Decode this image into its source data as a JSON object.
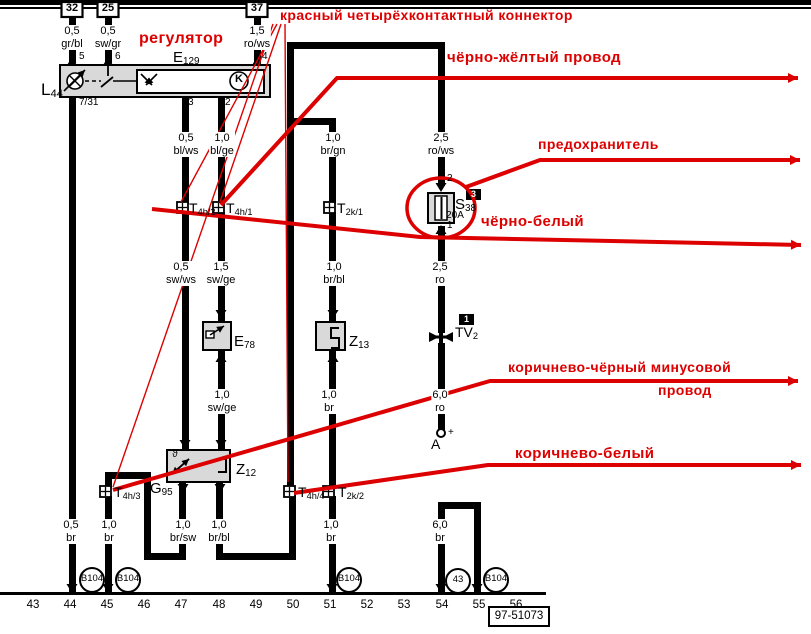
{
  "colors": {
    "wire": "#000000",
    "red": "#dd0000",
    "box_fill": "#d9d9d9"
  },
  "top_bus": {
    "bar": [
      0,
      0,
      811,
      5
    ],
    "line": [
      0,
      7,
      811,
      2
    ]
  },
  "ground_line": [
    0,
    592,
    546,
    3
  ],
  "terminals": [
    {
      "label": "32",
      "cx": 72
    },
    {
      "label": "25",
      "cx": 108
    },
    {
      "label": "37",
      "cx": 257
    }
  ],
  "segments": [
    [
      69,
      17,
      7,
      46
    ],
    [
      105,
      17,
      7,
      46
    ],
    [
      254,
      17,
      7,
      46
    ],
    [
      69,
      97,
      7,
      498
    ],
    [
      182,
      97,
      7,
      107
    ],
    [
      218,
      97,
      7,
      107
    ],
    [
      182,
      212,
      7,
      240
    ],
    [
      218,
      212,
      7,
      110
    ],
    [
      218,
      350,
      7,
      102
    ],
    [
      287,
      42,
      157,
      7
    ],
    [
      287,
      42,
      7,
      447
    ],
    [
      438,
      42,
      7,
      144
    ],
    [
      290,
      118,
      43,
      7
    ],
    [
      329,
      118,
      7,
      86
    ],
    [
      329,
      212,
      7,
      110
    ],
    [
      329,
      350,
      7,
      138
    ],
    [
      329,
      496,
      7,
      99
    ],
    [
      438,
      226,
      7,
      107
    ],
    [
      438,
      343,
      7,
      89
    ],
    [
      105,
      472,
      46,
      7
    ],
    [
      105,
      472,
      7,
      16
    ],
    [
      144,
      472,
      7,
      88
    ],
    [
      144,
      553,
      42,
      7
    ],
    [
      179,
      482,
      7,
      78
    ],
    [
      105,
      496,
      7,
      99
    ],
    [
      216,
      482,
      7,
      78
    ],
    [
      216,
      553,
      80,
      7
    ],
    [
      289,
      494,
      7,
      66
    ],
    [
      438,
      502,
      43,
      7
    ],
    [
      438,
      502,
      7,
      93
    ],
    [
      474,
      502,
      7,
      93
    ]
  ],
  "arrows": {
    "up": [
      [
        72,
        57
      ],
      [
        108,
        57
      ],
      [
        257,
        57
      ],
      [
        441,
        225
      ],
      [
        221,
        353
      ],
      [
        333,
        353
      ]
    ],
    "down": [
      [
        72,
        593
      ],
      [
        108,
        593
      ],
      [
        332,
        593
      ],
      [
        441,
        593
      ],
      [
        477,
        593
      ],
      [
        441,
        192
      ],
      [
        221,
        319
      ],
      [
        333,
        319
      ],
      [
        185,
        449
      ],
      [
        221,
        449
      ],
      [
        183,
        493
      ],
      [
        220,
        493
      ]
    ]
  },
  "boxes": [
    {
      "name": "e129-box",
      "r": [
        60,
        65,
        210,
        32
      ],
      "fill": "#d9d9d9"
    },
    {
      "name": "e129-inner-box",
      "r": [
        137,
        70,
        127,
        23
      ],
      "fill": "#ffffff"
    },
    {
      "name": "e78-box",
      "r": [
        203,
        322,
        28,
        28
      ],
      "fill": "#d9d9d9"
    },
    {
      "name": "z13-box",
      "r": [
        316,
        322,
        29,
        28
      ],
      "fill": "#d9d9d9"
    },
    {
      "name": "z12-box",
      "r": [
        167,
        450,
        63,
        32
      ],
      "fill": "#d9d9d9"
    },
    {
      "name": "fuse-box",
      "r": [
        428,
        193,
        26,
        30
      ],
      "fill": "#d9d9d9"
    }
  ],
  "connector_icons": [
    [
      177,
      202
    ],
    [
      213,
      202
    ],
    [
      324,
      202
    ],
    [
      100,
      486
    ],
    [
      284,
      486
    ],
    [
      323,
      486
    ]
  ],
  "connector_labels": [
    {
      "main": "T",
      "sub": "4h/2",
      "x": 189,
      "y": 201
    },
    {
      "main": "T",
      "sub": "4h/1",
      "x": 226,
      "y": 201
    },
    {
      "main": "T",
      "sub": "2k/1",
      "x": 337,
      "y": 201
    },
    {
      "main": "T",
      "sub": "4h/3",
      "x": 114,
      "y": 485
    },
    {
      "main": "T",
      "sub": "4h/4",
      "x": 298,
      "y": 485
    },
    {
      "main": "T",
      "sub": "2k/2",
      "x": 338,
      "y": 485
    }
  ],
  "component_labels": [
    {
      "main": "E",
      "sub": "129",
      "x": 173,
      "y": 50,
      "size": 15
    },
    {
      "main": "L",
      "sub": "44",
      "x": 41,
      "y": 81,
      "size": 17
    },
    {
      "main": "S",
      "sub": "38",
      "x": 455,
      "y": 197,
      "size": 15
    },
    {
      "main": "E",
      "sub": "78",
      "x": 234,
      "y": 334,
      "size": 15
    },
    {
      "main": "Z",
      "sub": "13",
      "x": 349,
      "y": 334,
      "size": 15
    },
    {
      "main": "Z",
      "sub": "12",
      "x": 236,
      "y": 462,
      "size": 15
    },
    {
      "main": "G",
      "sub": "95",
      "x": 150,
      "y": 481,
      "size": 15
    },
    {
      "main": "TV",
      "sub": "2",
      "x": 455,
      "y": 325,
      "size": 14
    },
    {
      "main": "A",
      "sub": "",
      "x": 431,
      "y": 437,
      "size": 14
    }
  ],
  "pin_labels": [
    {
      "t": "5",
      "x": 79,
      "y": 52
    },
    {
      "t": "6",
      "x": 115,
      "y": 52
    },
    {
      "t": "4",
      "x": 262,
      "y": 52
    },
    {
      "t": "7/31",
      "x": 79,
      "y": 98
    },
    {
      "t": "3",
      "x": 188,
      "y": 98
    },
    {
      "t": "2",
      "x": 225,
      "y": 98
    },
    {
      "t": "2",
      "x": 447,
      "y": 174
    },
    {
      "t": "1",
      "x": 447,
      "y": 221
    },
    {
      "t": "+",
      "x": 448,
      "y": 428
    }
  ],
  "misc_texts": [
    {
      "t": "K",
      "x": 239,
      "y": 74,
      "size": 11,
      "bold": true
    },
    {
      "t": "ϑ",
      "x": 175,
      "y": 450,
      "size": 10,
      "bold": false
    },
    {
      "t": "20A",
      "x": 455,
      "y": 211,
      "size": 10,
      "bold": false
    }
  ],
  "wire_labels": [
    {
      "l1": "0,5",
      "l2": "gr/bl",
      "x": 72,
      "y": 25
    },
    {
      "l1": "0,5",
      "l2": "sw/gr",
      "x": 108,
      "y": 25
    },
    {
      "l1": "1,5",
      "l2": "ro/ws",
      "x": 257,
      "y": 25
    },
    {
      "l1": "0,5",
      "l2": "bl/ws",
      "x": 186,
      "y": 132
    },
    {
      "l1": "1,0",
      "l2": "bl/ge",
      "x": 222,
      "y": 132
    },
    {
      "l1": "1,0",
      "l2": "br/gn",
      "x": 333,
      "y": 132
    },
    {
      "l1": "2,5",
      "l2": "ro/ws",
      "x": 441,
      "y": 132
    },
    {
      "l1": "0,5",
      "l2": "sw/ws",
      "x": 181,
      "y": 261
    },
    {
      "l1": "1,5",
      "l2": "sw/ge",
      "x": 221,
      "y": 261
    },
    {
      "l1": "1,0",
      "l2": "br/bl",
      "x": 334,
      "y": 261
    },
    {
      "l1": "2,5",
      "l2": "ro",
      "x": 440,
      "y": 261
    },
    {
      "l1": "1,0",
      "l2": "sw/ge",
      "x": 222,
      "y": 389
    },
    {
      "l1": "1,0",
      "l2": "br",
      "x": 329,
      "y": 389
    },
    {
      "l1": "6,0",
      "l2": "ro",
      "x": 440,
      "y": 389
    },
    {
      "l1": "0,5",
      "l2": "br",
      "x": 71,
      "y": 519
    },
    {
      "l1": "1,0",
      "l2": "br",
      "x": 109,
      "y": 519
    },
    {
      "l1": "1,0",
      "l2": "br/sw",
      "x": 183,
      "y": 519
    },
    {
      "l1": "1,0",
      "l2": "br/bl",
      "x": 219,
      "y": 519
    },
    {
      "l1": "1,0",
      "l2": "br",
      "x": 331,
      "y": 519
    },
    {
      "l1": "6,0",
      "l2": "br",
      "x": 440,
      "y": 519
    }
  ],
  "grounds": [
    {
      "t": "B104",
      "cx": 92,
      "cy": 580
    },
    {
      "t": "B104",
      "cx": 128,
      "cy": 580
    },
    {
      "t": "B104",
      "cx": 349,
      "cy": 580
    },
    {
      "t": "43",
      "cx": 458,
      "cy": 581
    },
    {
      "t": "B104",
      "cx": 496,
      "cy": 580
    }
  ],
  "scale": {
    "y": 599,
    "items": [
      {
        "t": "43",
        "cx": 33
      },
      {
        "t": "44",
        "cx": 70
      },
      {
        "t": "45",
        "cx": 107
      },
      {
        "t": "46",
        "cx": 144
      },
      {
        "t": "47",
        "cx": 181
      },
      {
        "t": "48",
        "cx": 219
      },
      {
        "t": "49",
        "cx": 256
      },
      {
        "t": "50",
        "cx": 293
      },
      {
        "t": "51",
        "cx": 330
      },
      {
        "t": "52",
        "cx": 367
      },
      {
        "t": "53",
        "cx": 404
      },
      {
        "t": "54",
        "cx": 442
      },
      {
        "t": "55",
        "cx": 479
      },
      {
        "t": "56",
        "cx": 516
      }
    ]
  },
  "ref_box": {
    "text": "97-51073",
    "x": 489,
    "y": 607,
    "w": 60,
    "h": 19
  },
  "tags": [
    {
      "t": "3",
      "x": 466,
      "y": 189
    },
    {
      "t": "1",
      "x": 459,
      "y": 314
    }
  ],
  "fuse": {
    "inner": [
      435,
      196,
      12,
      24
    ],
    "ellipse": {
      "cx": 441,
      "cy": 208,
      "rx": 34,
      "ry": 30
    }
  },
  "tv2_junction": {
    "cx": 441,
    "cy": 337
  },
  "battery_terminal": {
    "cx": 441,
    "cy": 433,
    "r": 4
  },
  "red_texts": [
    {
      "t": "красный четырёхконтактный коннектор",
      "x": 280,
      "y": 8,
      "size": 14
    },
    {
      "t": "регулятор",
      "x": 139,
      "y": 30,
      "size": 16
    },
    {
      "t": "чёрно-жёлтый провод",
      "x": 447,
      "y": 50,
      "size": 15
    },
    {
      "t": "предохранитель",
      "x": 538,
      "y": 137,
      "size": 14
    },
    {
      "t": "чёрно-белый",
      "x": 481,
      "y": 214,
      "size": 15
    },
    {
      "t": "коричнево-чёрный минусовой",
      "x": 508,
      "y": 360,
      "size": 14
    },
    {
      "t": "провод",
      "x": 658,
      "y": 383,
      "size": 14
    },
    {
      "t": "коричнево-белый",
      "x": 515,
      "y": 446,
      "size": 15
    }
  ],
  "red_thick": [
    {
      "name": "callout-black-yellow-wire",
      "pts": [
        [
          221,
          205
        ],
        [
          337,
          78
        ],
        [
          798,
          78
        ]
      ],
      "arrow": true
    },
    {
      "name": "callout-fuse",
      "pts": [
        [
          466,
          187
        ],
        [
          540,
          160
        ],
        [
          800,
          160
        ]
      ],
      "arrow": true
    },
    {
      "name": "callout-black-white-wire",
      "pts": [
        [
          152,
          209
        ],
        [
          420,
          237
        ],
        [
          801,
          245
        ]
      ],
      "arrow": true
    },
    {
      "name": "callout-brown-black-wire",
      "pts": [
        [
          113,
          490
        ],
        [
          490,
          381
        ],
        [
          798,
          381
        ]
      ],
      "arrow": true
    },
    {
      "name": "callout-brown-white-wire",
      "pts": [
        [
          294,
          493
        ],
        [
          488,
          465
        ],
        [
          801,
          465
        ]
      ],
      "arrow": true
    }
  ],
  "red_thin": [
    {
      "name": "pointer-t4h3",
      "pts": [
        [
          273,
          24
        ],
        [
          113,
          487
        ]
      ]
    },
    {
      "name": "pointer-t4h2",
      "pts": [
        [
          277,
          24
        ],
        [
          181,
          202
        ]
      ]
    },
    {
      "name": "pointer-t4h1",
      "pts": [
        [
          281,
          24
        ],
        [
          220,
          202
        ]
      ]
    },
    {
      "name": "pointer-t4h4",
      "pts": [
        [
          285,
          24
        ],
        [
          288,
          482
        ]
      ]
    }
  ],
  "art": [
    {
      "k": "circle",
      "cx": 75,
      "cy": 81,
      "r": 8,
      "sw": 1.6,
      "fill": "#fff",
      "nm": "lamp-symbol"
    },
    {
      "k": "line",
      "x1": 69.7,
      "y1": 75.7,
      "x2": 80.3,
      "y2": 86.3,
      "w": 1.4,
      "nm": "lamp-x1"
    },
    {
      "k": "line",
      "x1": 80.3,
      "y1": 75.7,
      "x2": 69.7,
      "y2": 86.3,
      "w": 1.4,
      "nm": "lamp-x2"
    },
    {
      "k": "arrow",
      "x1": 64,
      "y1": 91,
      "x2": 85,
      "y2": 70,
      "w": 1.6,
      "nm": "dimmer-arrow"
    },
    {
      "k": "dline",
      "x1": 85,
      "y1": 81,
      "x2": 101,
      "y2": 81,
      "w": 1.6,
      "nm": "dashed-link"
    },
    {
      "k": "line",
      "x1": 101,
      "y1": 87,
      "x2": 113,
      "y2": 77,
      "w": 1.8,
      "nm": "switch-blade"
    },
    {
      "k": "line",
      "x1": 108,
      "y1": 66,
      "x2": 108,
      "y2": 76,
      "w": 1.8,
      "nm": "switch-drop"
    },
    {
      "k": "line",
      "x1": 113,
      "y1": 81,
      "x2": 137,
      "y2": 81,
      "w": 1.4,
      "nm": "switch-link"
    },
    {
      "k": "arrow",
      "x1": 141,
      "y1": 74,
      "x2": 152,
      "y2": 85,
      "w": 1.6,
      "nm": "reg-arrow-1"
    },
    {
      "k": "arrow",
      "x1": 157,
      "y1": 74,
      "x2": 146,
      "y2": 85,
      "w": 1.6,
      "nm": "reg-arrow-2"
    },
    {
      "k": "circle",
      "cx": 239,
      "cy": 81,
      "r": 9,
      "sw": 1.6,
      "fill": "#fff",
      "nm": "k-circle"
    },
    {
      "k": "rect",
      "x": 206,
      "y": 331,
      "w": 8,
      "h": 7,
      "sw": 1.4,
      "fill": "#fff",
      "nm": "e78-contact"
    },
    {
      "k": "arrow",
      "x1": 210,
      "y1": 335,
      "x2": 224,
      "y2": 326,
      "w": 1.6,
      "nm": "e78-blade"
    },
    {
      "k": "path",
      "d": "M339,328 H331 V338 H339 V348 H331",
      "w": 2,
      "nm": "z13-element"
    },
    {
      "k": "arrow",
      "x1": 172,
      "y1": 474,
      "x2": 189,
      "y2": 459,
      "w": 1.8,
      "nm": "g95-sensor-arrow"
    },
    {
      "k": "arrow",
      "x1": 189,
      "y1": 459,
      "x2": 172,
      "y2": 474,
      "w": 1.8,
      "nm": "g95-sensor-arrow-2"
    },
    {
      "k": "path",
      "d": "M218,459 h8 v13 h-8",
      "w": 2,
      "nm": "z12-element"
    },
    {
      "k": "line",
      "x1": 441.5,
      "y1": 197,
      "x2": 441.5,
      "y2": 219,
      "w": 2,
      "nm": "fuse-wire"
    }
  ]
}
